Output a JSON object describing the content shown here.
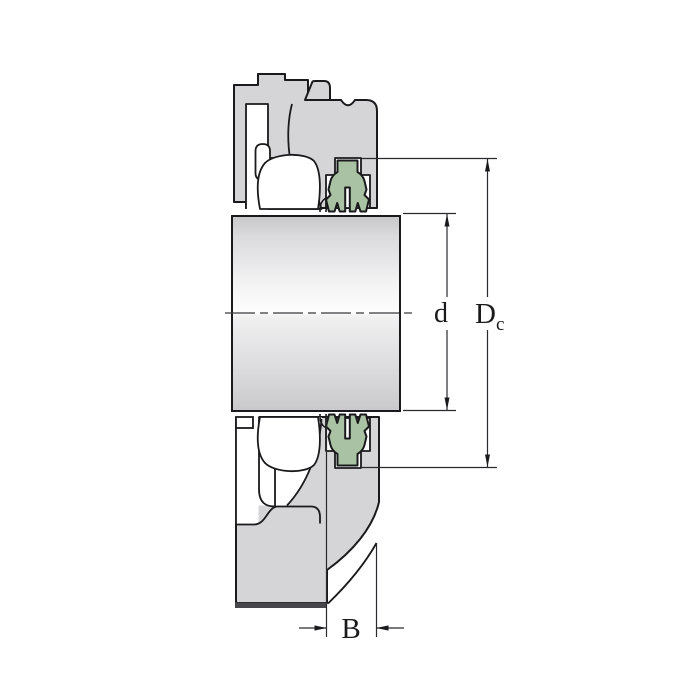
{
  "figure": {
    "type": "technical-drawing",
    "subject": "Bearing unit cross-section with shaft, housing, green contact seal and dimension annotations",
    "background": "#ffffff"
  },
  "dimensions": {
    "d_label": "d",
    "dc_main": "D",
    "dc_sub": "c",
    "b_label": "B"
  },
  "colors": {
    "outline": "#1a1a1c",
    "housing_gray": "#d5d5d8",
    "seal_green": "#a9c2a3",
    "dim_line": "#2a2a2e",
    "base_edge_dark": "#47474b",
    "white": "#ffffff"
  }
}
